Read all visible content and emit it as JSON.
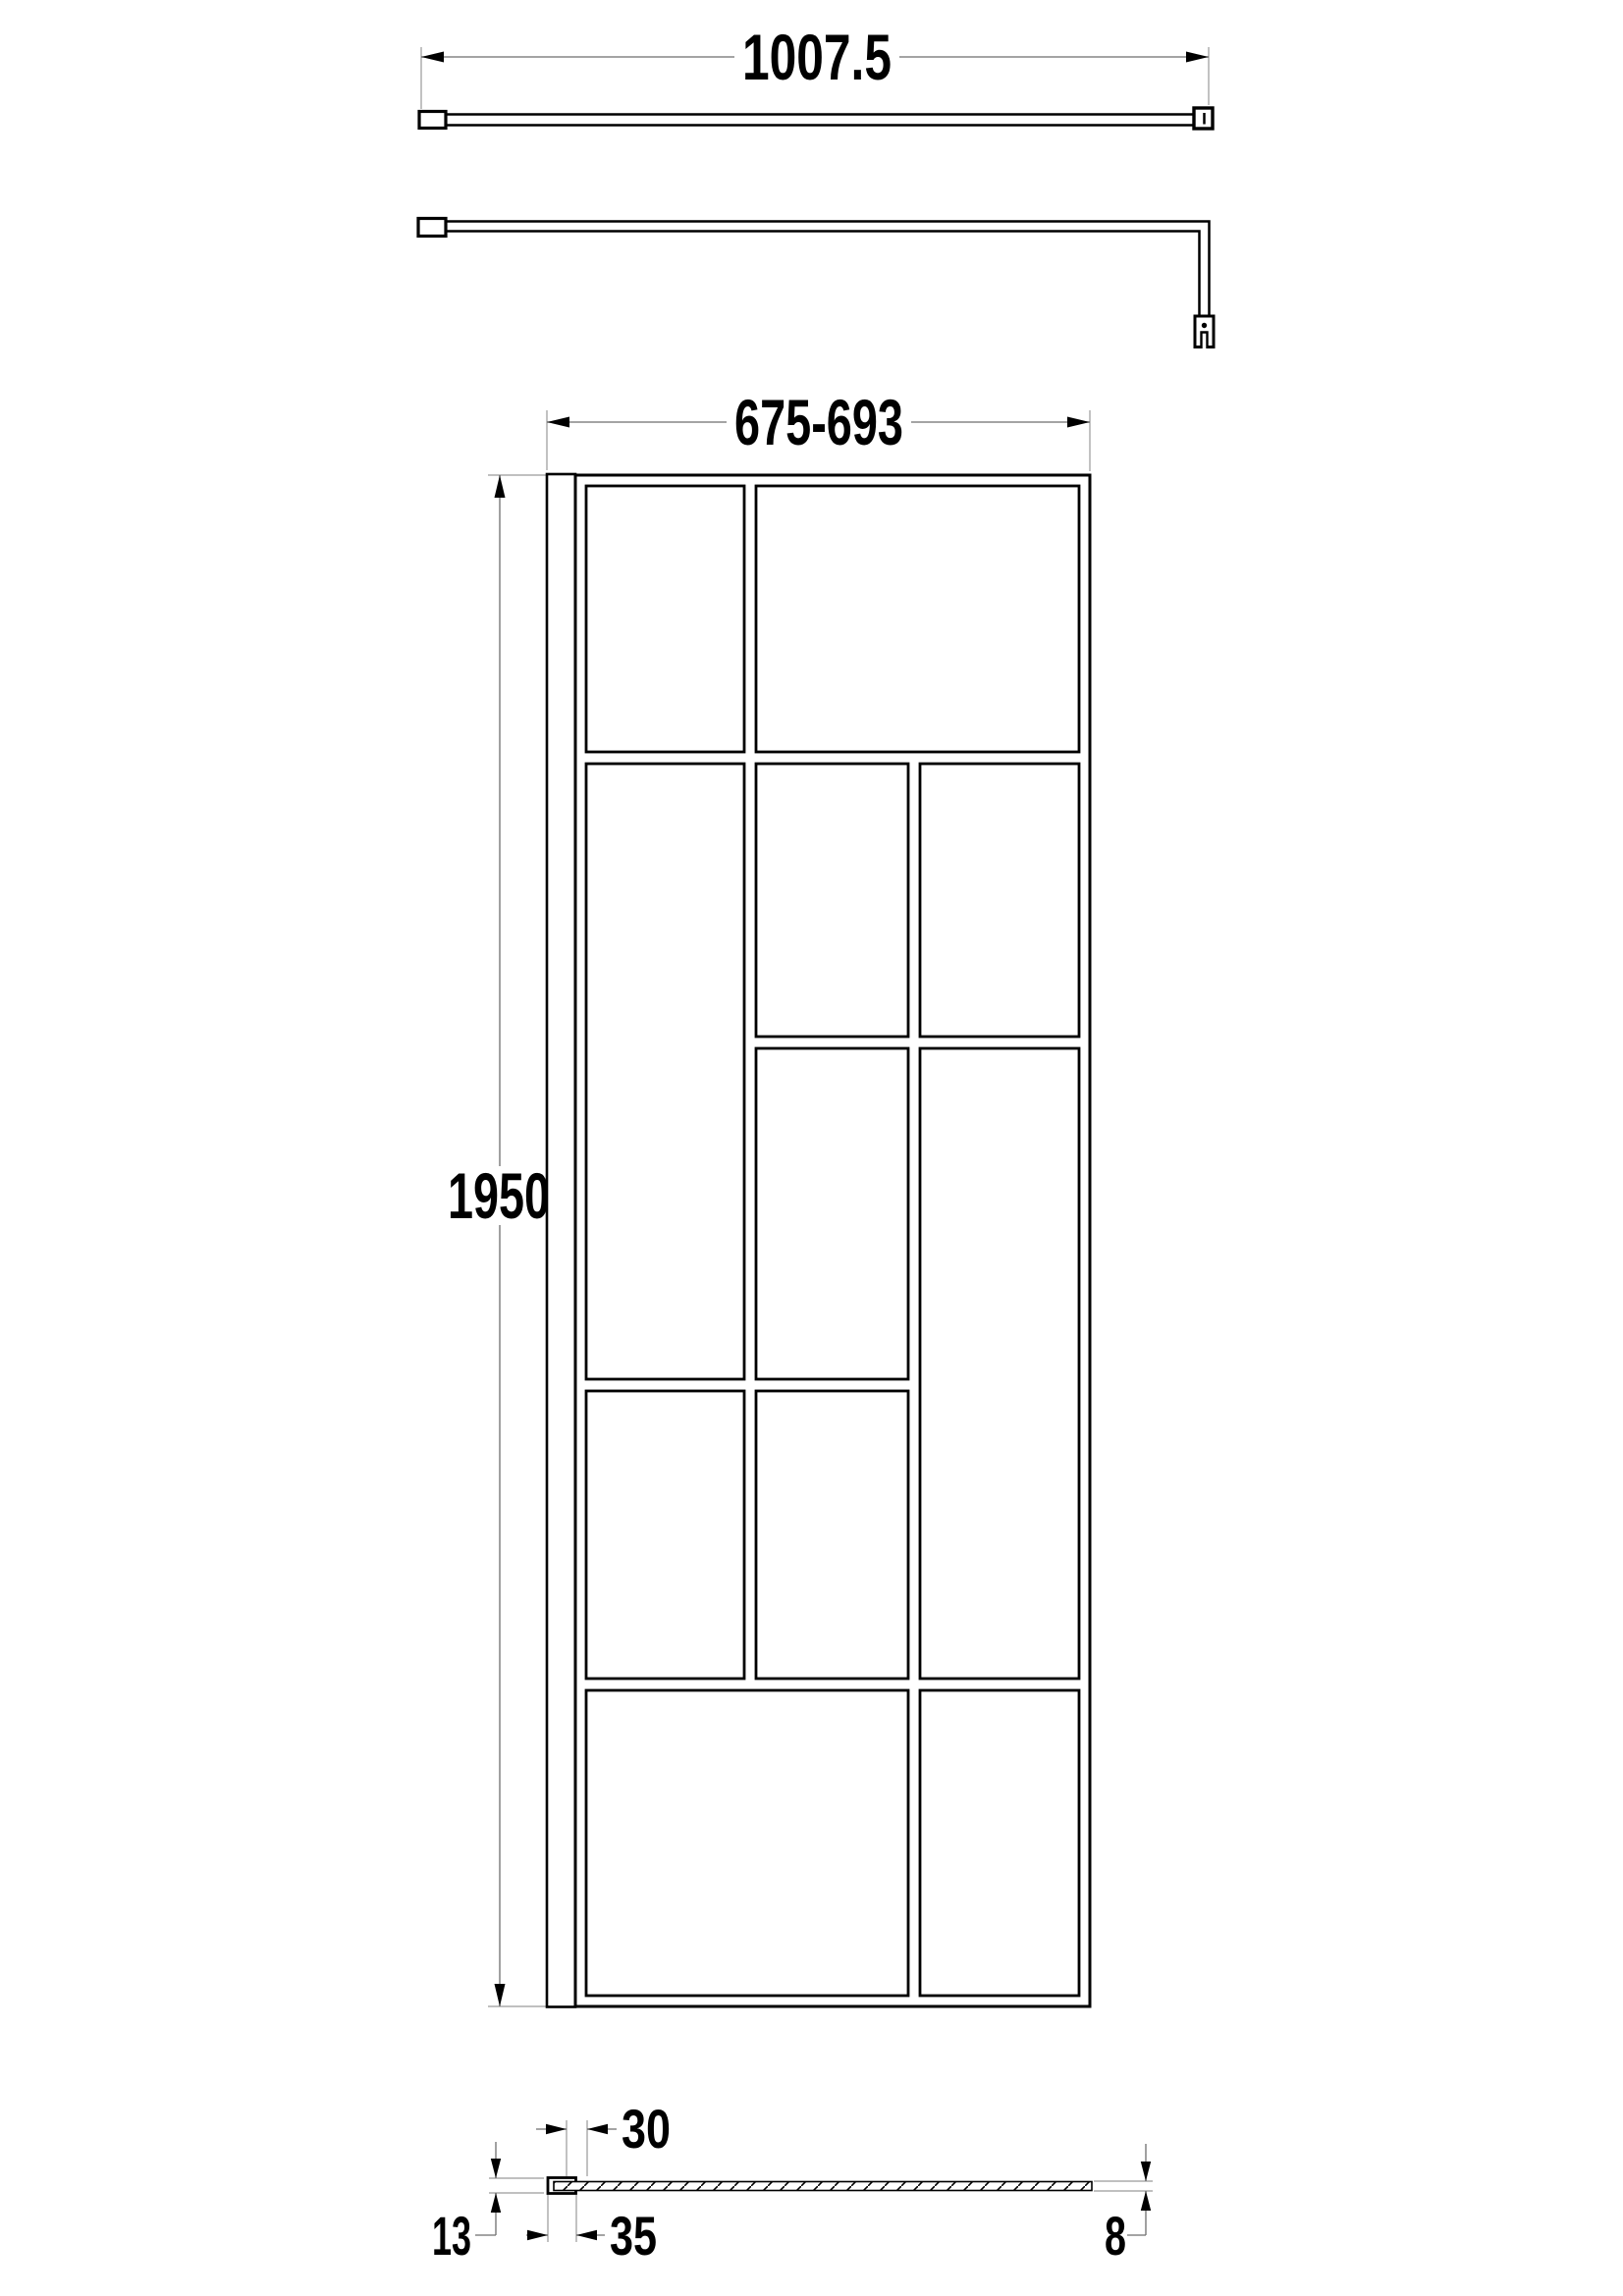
{
  "dimensions": {
    "support_bar_length": "1007.5",
    "screen_width_range": "675-693",
    "screen_height": "1950",
    "profile_adjustment": "30",
    "wall_profile_width": "35",
    "wall_profile_depth": "13",
    "glass_thickness": "8"
  },
  "structure": {
    "glass_panes": 11,
    "grid_columns": 3,
    "views": 4
  },
  "colors": {
    "line": "#000000",
    "dimension_line": "#6e6e6e",
    "extension_line": "#9a9a9a",
    "background": "#ffffff"
  }
}
